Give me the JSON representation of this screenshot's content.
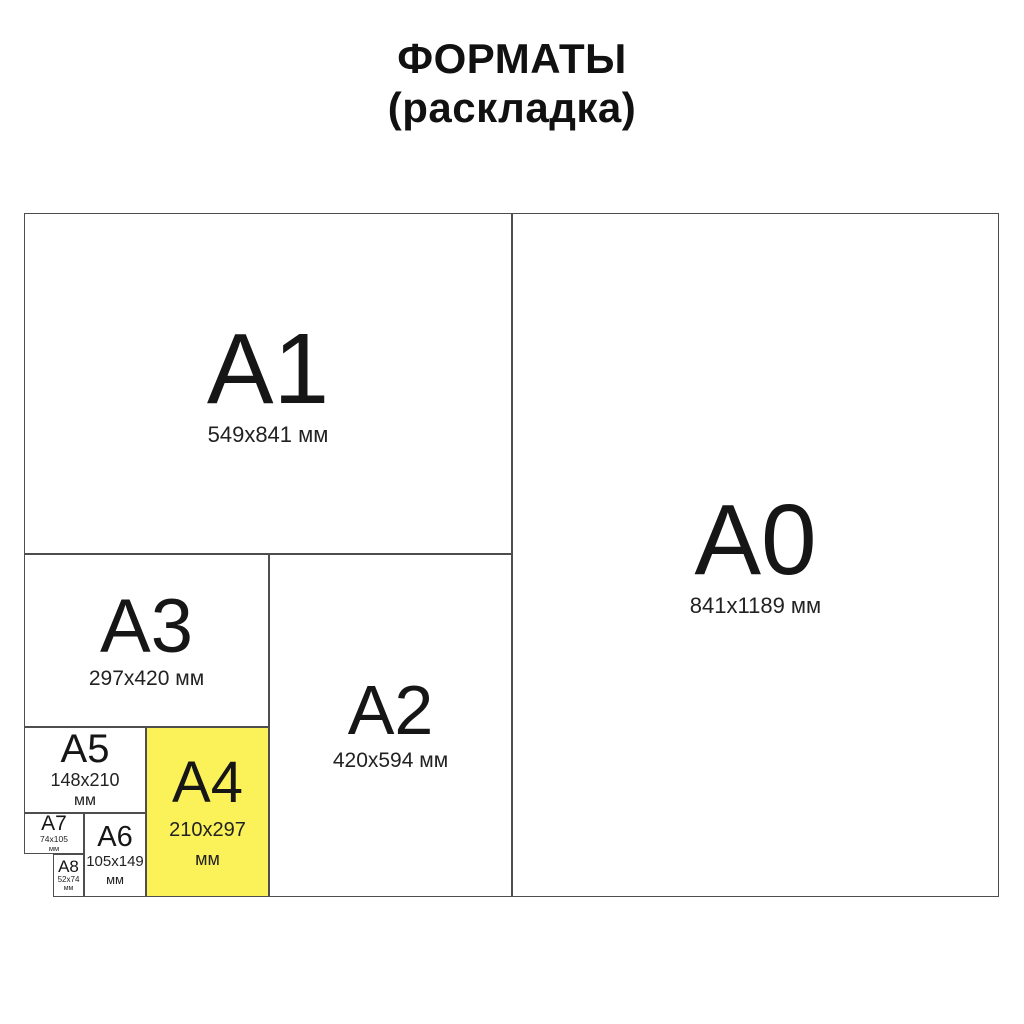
{
  "title": {
    "line1": "ФОРМАТЫ",
    "line2": "(раскладка)"
  },
  "colors": {
    "highlight": "#FBF159",
    "border": "#4e4e4e",
    "ink": "#1b1b1b",
    "bg": "#ffffff"
  },
  "formats": {
    "a0": {
      "label": "A0",
      "size": "841x1189 мм"
    },
    "a1": {
      "label": "A1",
      "size": "549x841 мм"
    },
    "a2": {
      "label": "A2",
      "size": "420x594 мм"
    },
    "a3": {
      "label": "A3",
      "size": "297x420 мм"
    },
    "a4": {
      "label": "A4",
      "size": "210x297",
      "unit": "мм",
      "highlighted": true
    },
    "a5": {
      "label": "A5",
      "size": "148x210",
      "unit": "мм"
    },
    "a6": {
      "label": "A6",
      "size": "105x149",
      "unit": "мм"
    },
    "a7": {
      "label": "A7",
      "size": "74x105",
      "unit": "мм"
    },
    "a8": {
      "label": "A8",
      "size": "52x74",
      "unit": "мм"
    }
  }
}
